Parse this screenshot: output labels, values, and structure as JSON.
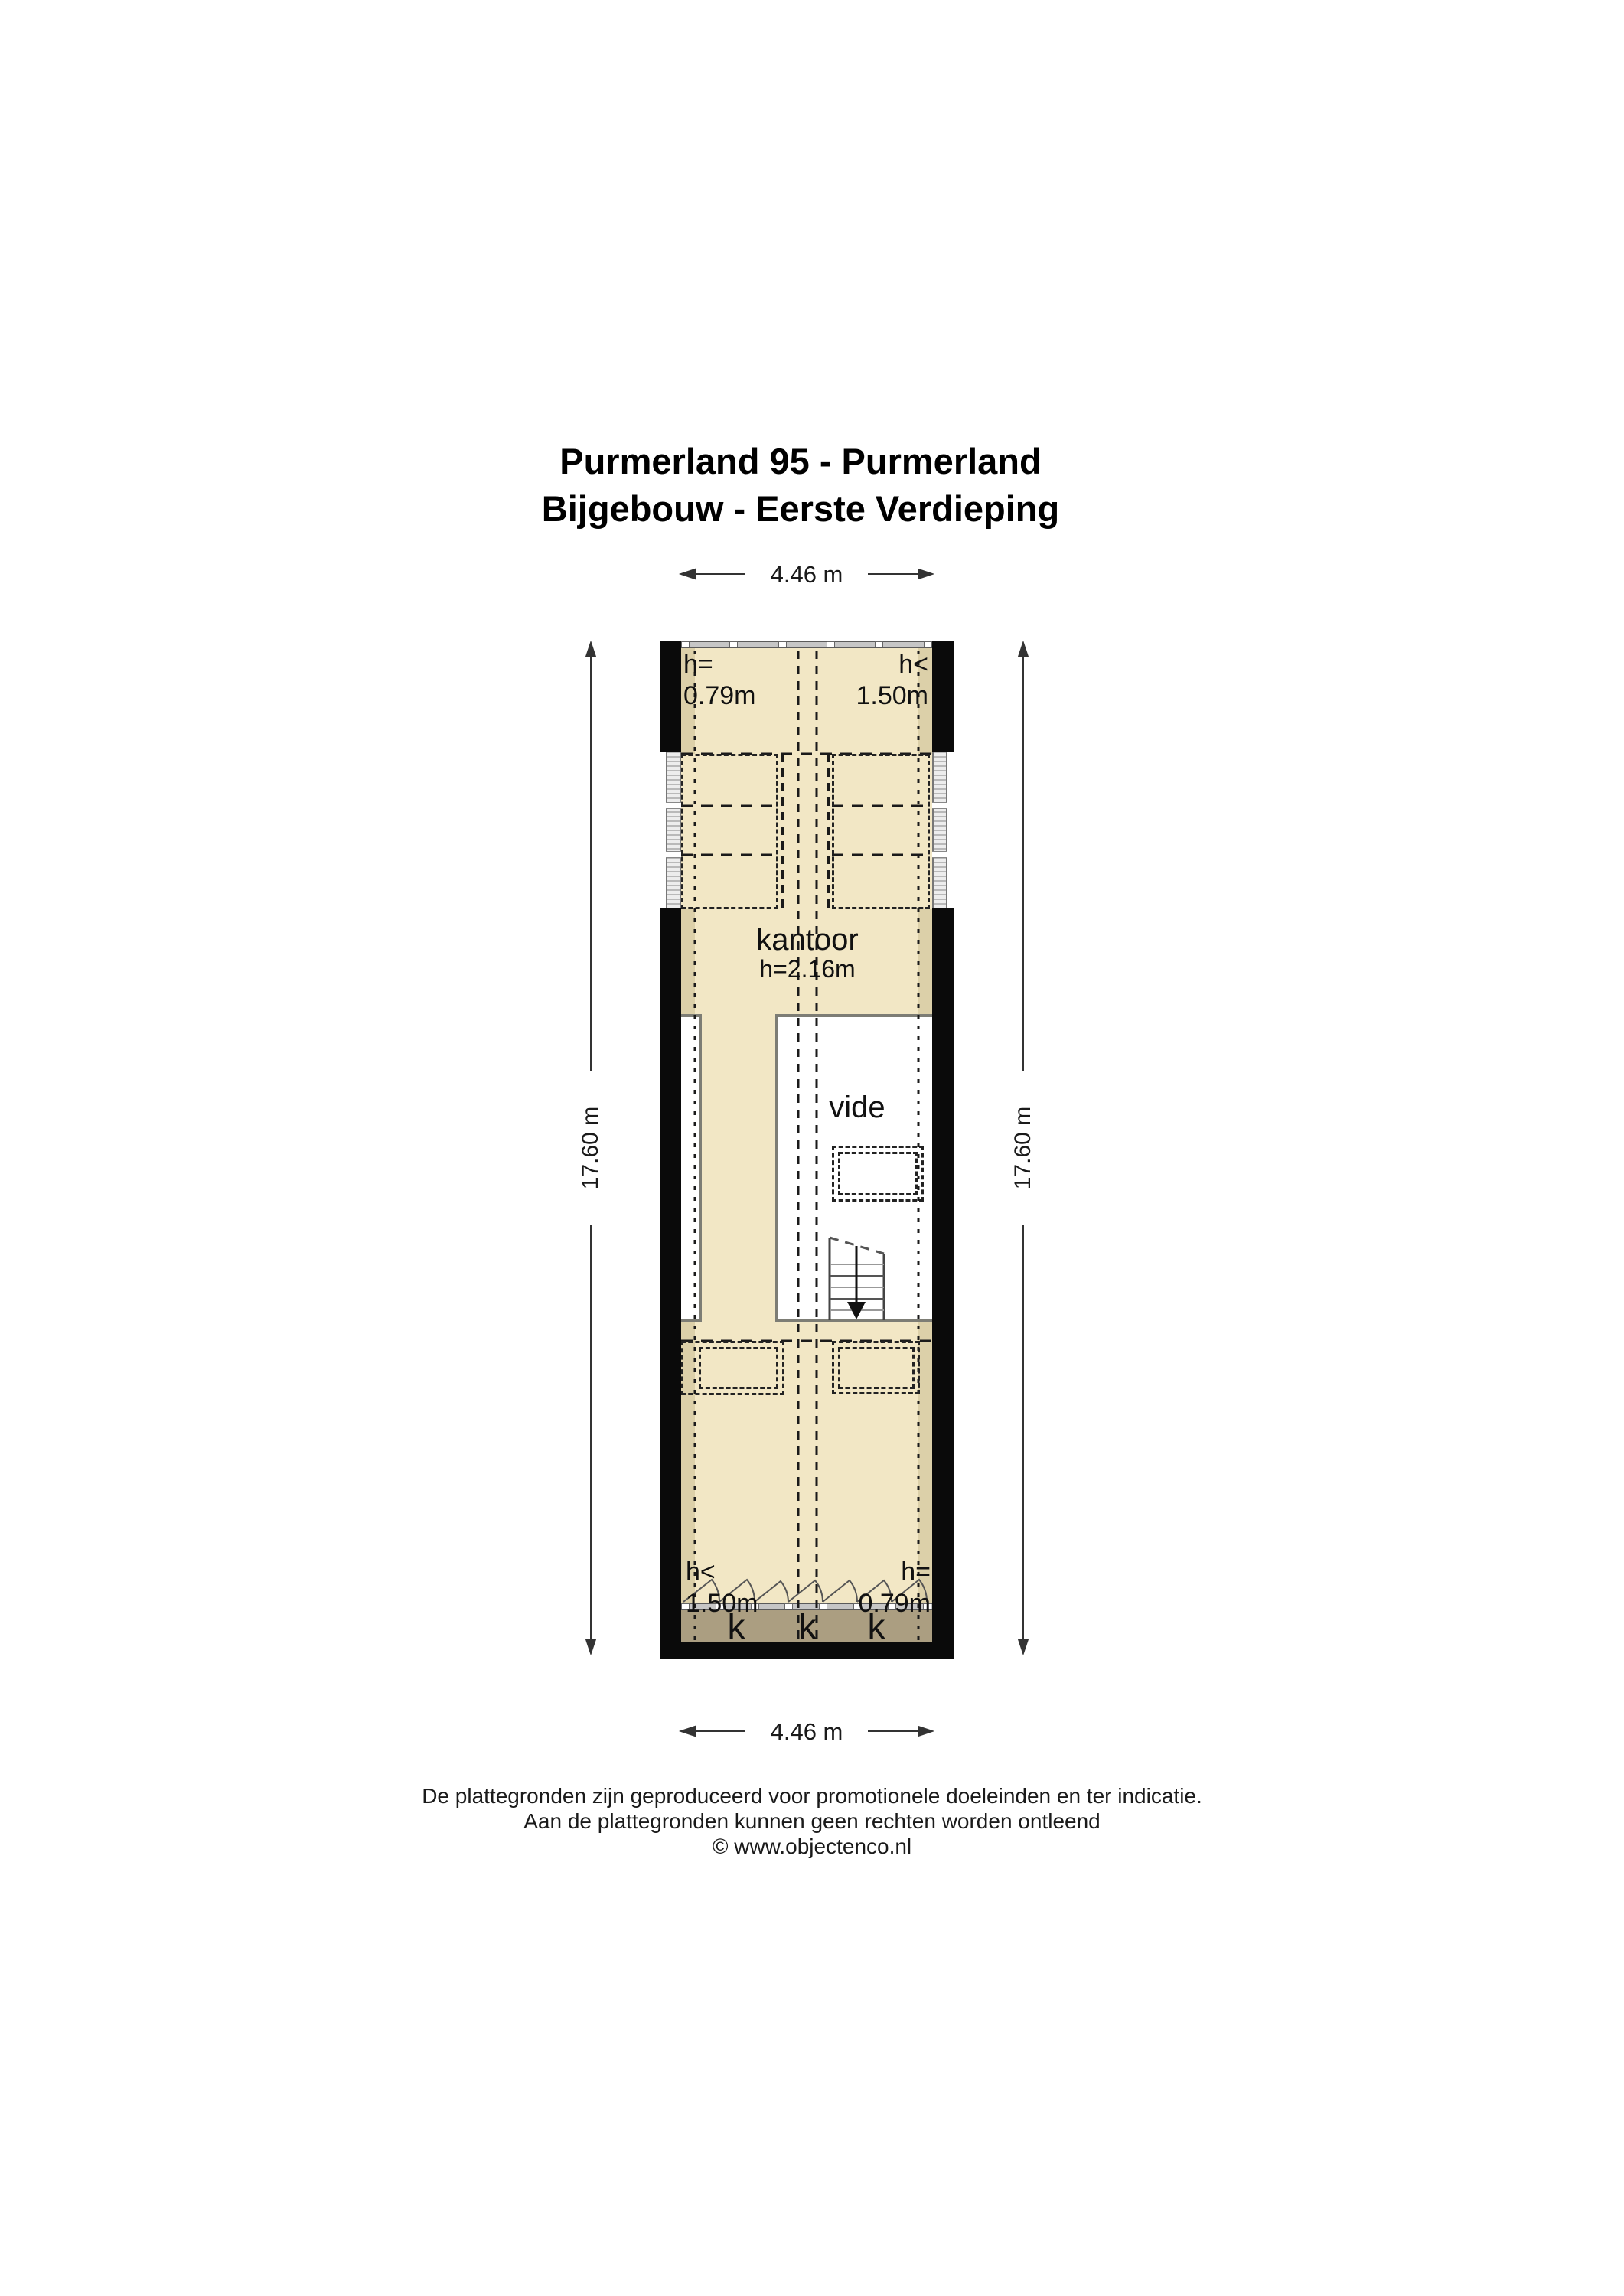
{
  "title": {
    "line1": "Purmerland 95 - Purmerland",
    "line2": "Bijgebouw - Eerste Verdieping"
  },
  "dimensions": {
    "top": "4.46 m",
    "bottom": "4.46 m",
    "left": "17.60 m",
    "right": "17.60 m"
  },
  "rooms": {
    "kantoor": {
      "name": "kantoor",
      "height": "h=2.16m"
    },
    "vide": {
      "name": "vide"
    }
  },
  "height_annotations": {
    "top_left": {
      "line1": "h=",
      "line2": "0.79m"
    },
    "top_right": {
      "line1": "h<",
      "line2": "1.50m"
    },
    "bottom_left": {
      "line1": "h<",
      "line2": "1.50m"
    },
    "bottom_right": {
      "line1": "h=",
      "line2": "0.79m"
    }
  },
  "closets": {
    "labels": [
      "k",
      "k",
      "k"
    ]
  },
  "footer": {
    "line1": "De plattegronden zijn geproduceerd voor promotionele doeleinden en ter indicatie.",
    "line2": "Aan de plattegronden kunnen geen rechten worden ontleend",
    "line3": "© www.objectenco.nl"
  },
  "colors": {
    "floor": "#F2E7C5",
    "floor_shade": "#DCD0A9",
    "closet_strip": "#AB9E81",
    "wall": "#0A0A0A",
    "window_gray": "#C6C6C6",
    "room_wall_gray": "#7D7D75"
  }
}
